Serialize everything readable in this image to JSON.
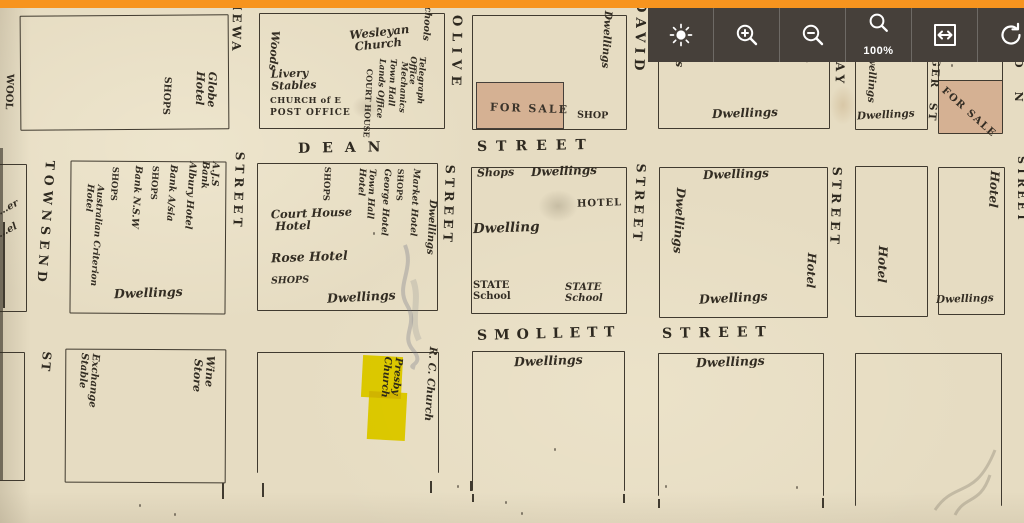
{
  "app": {
    "top_bar_color": "#f7941e"
  },
  "toolbar": {
    "bg": "#46403a",
    "icon_color": "#ffffff",
    "buttons": [
      {
        "id": "brightness",
        "icon": "sun-icon"
      },
      {
        "id": "zoom-in",
        "icon": "zoom-in-icon"
      },
      {
        "id": "zoom-out",
        "icon": "zoom-out-icon"
      },
      {
        "id": "zoom-level",
        "icon": "magnifier-icon",
        "label": "100%"
      },
      {
        "id": "fit-width",
        "icon": "fit-width-icon"
      },
      {
        "id": "rotate",
        "icon": "rotate-icon"
      }
    ]
  },
  "map": {
    "paper_color": "#e6dcc2",
    "line_color": "#403a2f",
    "highlight_color": "#f2e600",
    "for_sale_fill": "#d5b193",
    "streets": {
      "stanley": "STANLEY ST",
      "townsend": "TOWNSEND",
      "townsend_abbrev": "ST",
      "kiewa_partial": "IEWA",
      "dean": "DEAN",
      "olive": "OLIVE",
      "david": "DAVID",
      "macaulay_partial": "AY",
      "smollett": "SMOLLETT",
      "street_word": "STREET",
      "ger_st_partial": "GER ST",
      "right_edge_partial": "ON"
    },
    "labels": {
      "dwellings": "Dwellings",
      "dwelling": "Dwelling",
      "shops": "SHOPS",
      "shops_script": "Shops",
      "shop": "SHOP",
      "hotel": "Hotel",
      "hotel_caps": "HOTEL",
      "for_sale": "FOR SALE",
      "wool": "WOOL",
      "globe_hotel": "Globe\nHotel",
      "woods": "Woods",
      "wesleyan_church": "Wesleyan\n Church",
      "schools": "Schools",
      "livery_stables": "Livery\nStables",
      "church_of_e": "CHURCH of E",
      "post_office": "POST OFFICE",
      "court_house": "COURT HOUSE",
      "lands_office": "Lands Office",
      "town_hall": "Town Hall",
      "mechanics": "Mechanics",
      "telegraph_office": "Telegraph\nOffice",
      "ajs_bank": "A.J.S\nBank",
      "albury_hotel": "Albury Hotel",
      "bank_australasia": "Bank A/sia",
      "bank_nsw": "Bank N.S.W",
      "australian_criterion_hotel": "Australian Criterion\nHotel",
      "court_house_hotel": "Court House\n Hotel",
      "rose_hotel": "Rose Hotel",
      "town_hall_hotel": "Town Hall\nHotel",
      "george_hotel": "George Hotel",
      "market_hotel": "Market Hotel",
      "state_school": "STATE\nSchool",
      "exchange_stable": "Exchange\nStable",
      "wine_store": "Wine\n Store",
      "presby_church": "Presby\nChurch",
      "rc_church": "R. C. Church",
      "partial_left_row1b": "…er",
      "partial_left_row1": "…el"
    }
  }
}
